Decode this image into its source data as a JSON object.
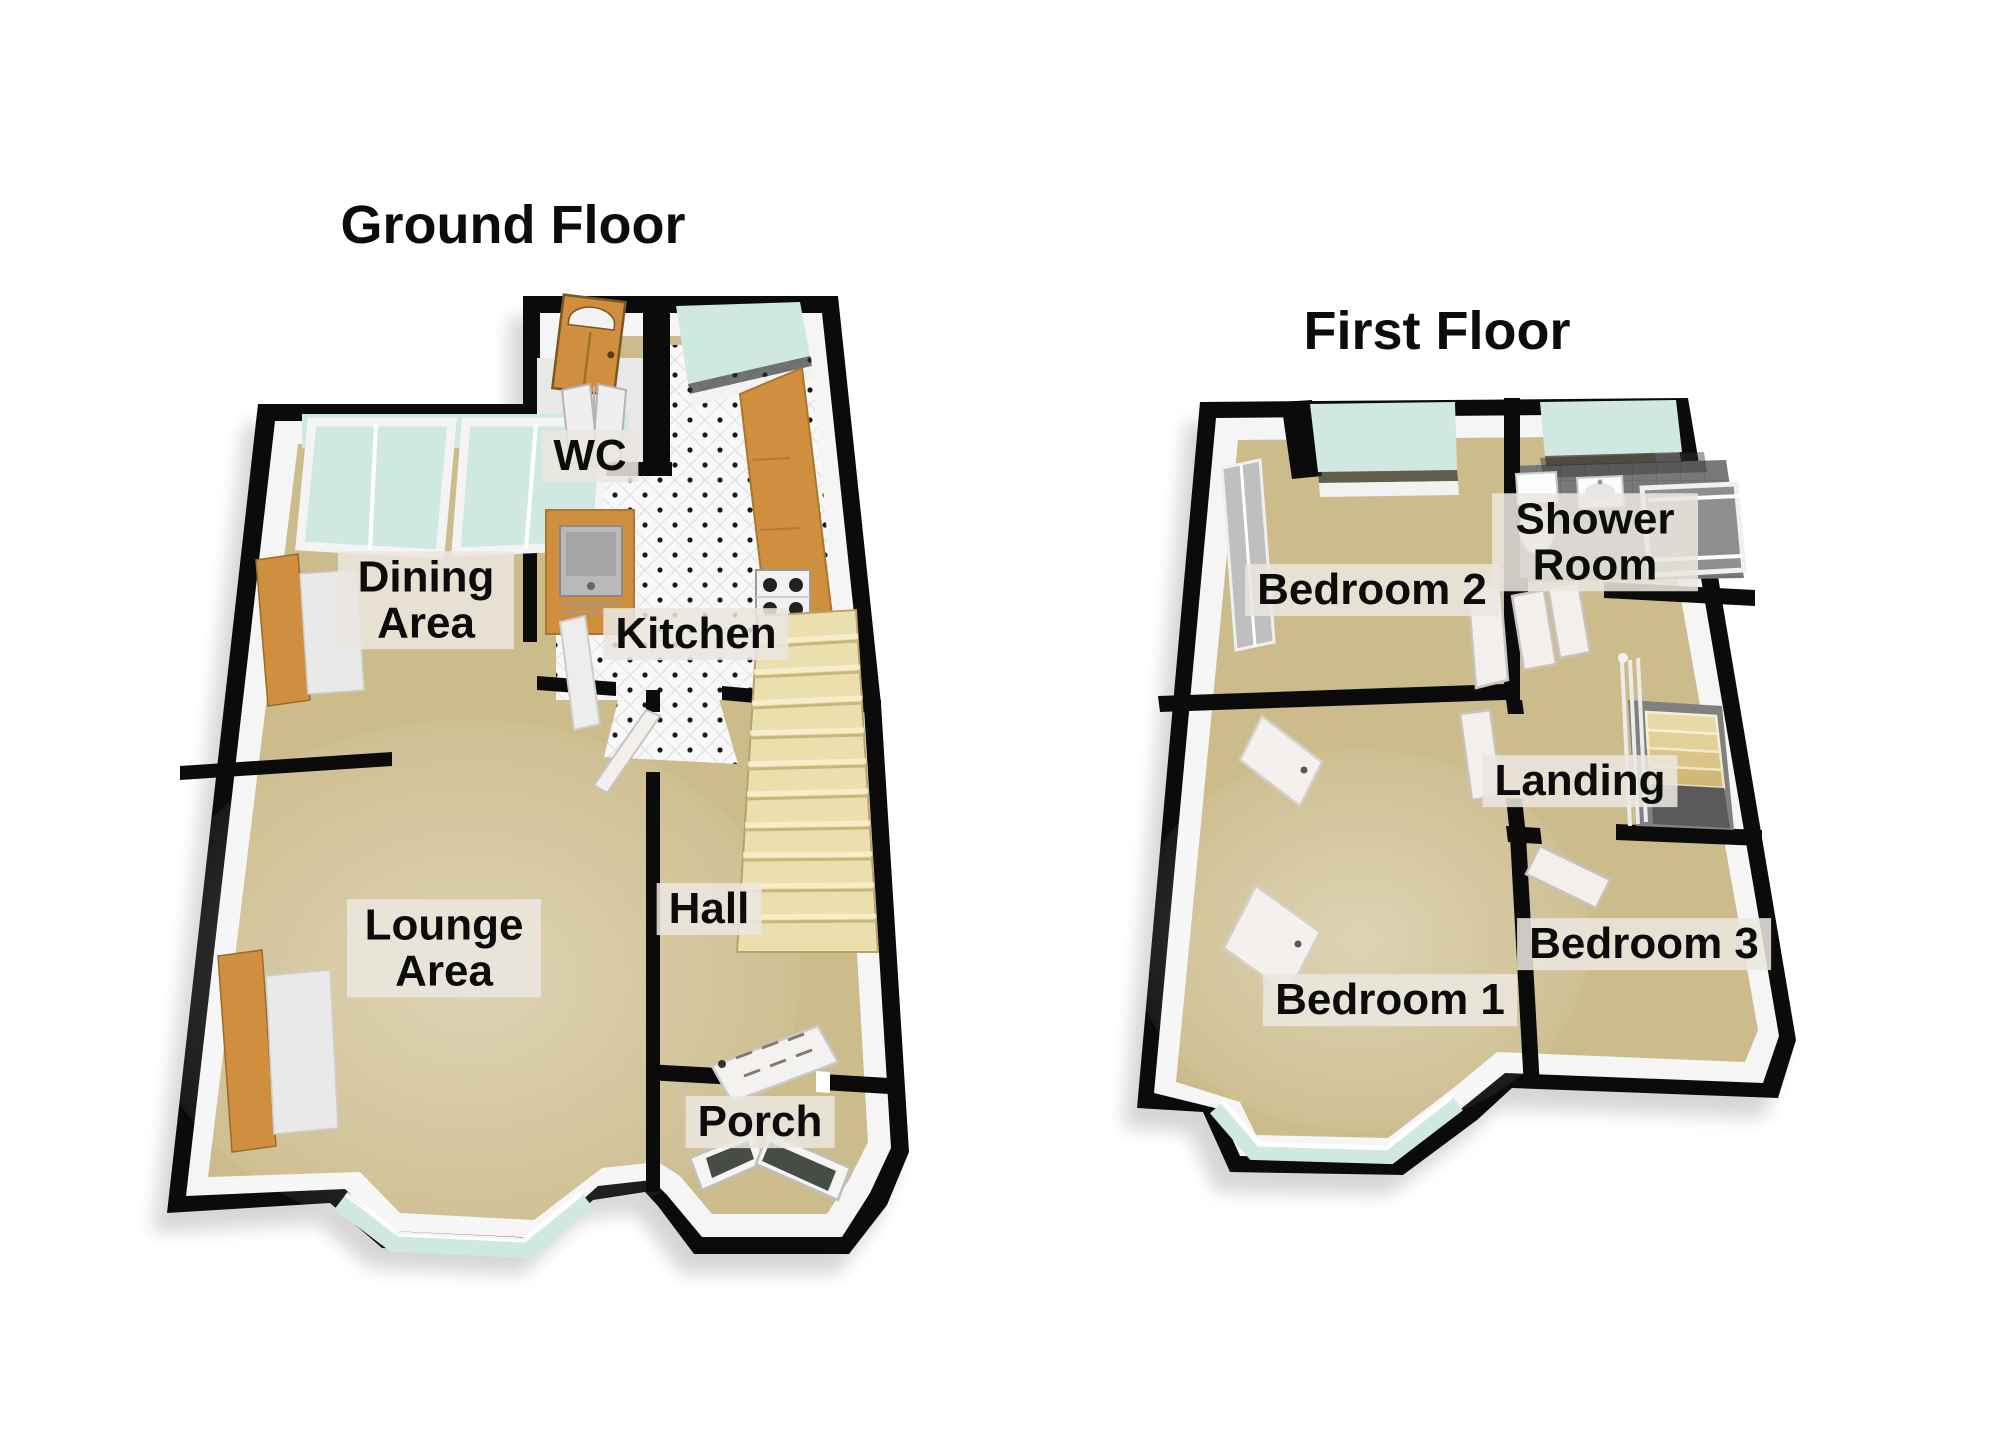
{
  "palette": {
    "page_bg": "#ffffff",
    "wall": "#0b0b0b",
    "inner_wall": "#f5f5f5",
    "carpet": "#ccbc8c",
    "carpet_dark": "#c2b181",
    "glass": "#cfe8e1",
    "glass_deep": "#aed2ca",
    "wood": "#cf8f3e",
    "wood_dark": "#9c6b28",
    "stair": "#ecdfae",
    "stair_line": "#c9b67c",
    "stair_hi": "#f8f0cf",
    "tile_bg": "#f8f8f8",
    "tile_dot": "#1a1a1a",
    "gray_floor": "#787878",
    "stairwell": "#808080",
    "door_white": "#f2efec",
    "label_bg": "rgba(234,231,223,0.87)",
    "label_text": "#0c0c0c"
  },
  "floors": [
    {
      "title": "Ground Floor",
      "rooms": [
        {
          "name": "dining-area",
          "label": "Dining Area"
        },
        {
          "name": "wc",
          "label": "WC"
        },
        {
          "name": "kitchen",
          "label": "Kitchen"
        },
        {
          "name": "lounge-area",
          "label": "Lounge Area"
        },
        {
          "name": "hall",
          "label": "Hall"
        },
        {
          "name": "porch",
          "label": "Porch"
        }
      ]
    },
    {
      "title": "First Floor",
      "rooms": [
        {
          "name": "bedroom-2",
          "label": "Bedroom 2"
        },
        {
          "name": "shower-room",
          "label": "Shower Room"
        },
        {
          "name": "landing",
          "label": "Landing"
        },
        {
          "name": "bedroom-3",
          "label": "Bedroom 3"
        },
        {
          "name": "bedroom-1",
          "label": "Bedroom 1"
        }
      ]
    }
  ]
}
